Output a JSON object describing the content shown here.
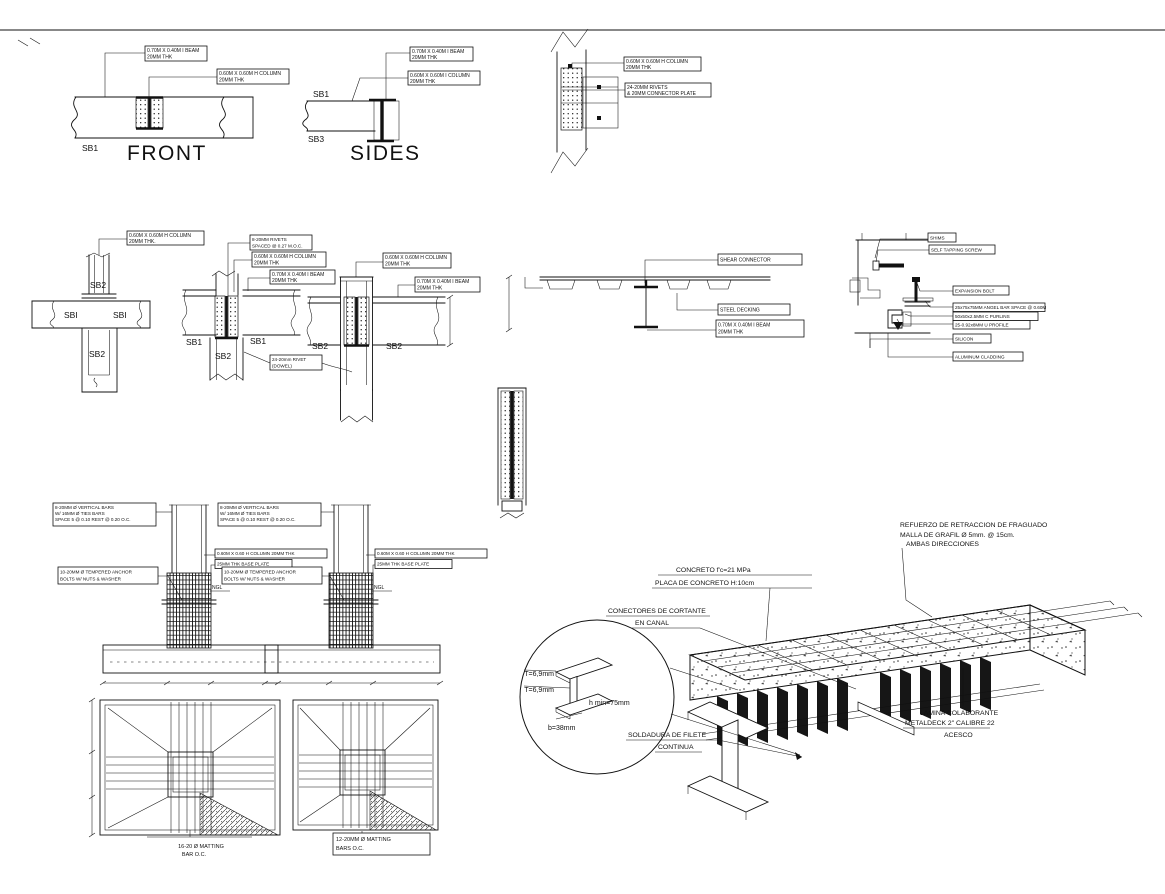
{
  "drawing": {
    "front_view": {
      "title": "FRONT",
      "member": "SB1",
      "beam_callout": [
        "0.70M X 0.40M I BEAM",
        "20MM THK"
      ],
      "column_callout": [
        "0.60M X 0.60M H COLUMN",
        "20MM THK"
      ]
    },
    "sides_view": {
      "title": "SIDES",
      "member_top": "SB1",
      "member_bottom": "SB3",
      "beam_callout": [
        "0.70M X 0.40M I BEAM",
        "20MM THK"
      ],
      "column_callout": [
        "0.60M X 0.60M I COLUMN",
        "20MM THK"
      ]
    },
    "splice_detail": {
      "column_callout": [
        "0.60M X 0.60M H COLUMN",
        "20MM THK"
      ],
      "rivets_callout": [
        "24-20MM RIVETS",
        "& 20MM CONNECTOR PLATE"
      ]
    },
    "plan_detail": {
      "column_callout": [
        "0.60M X 0.60M H COLUMN",
        "20MM THK."
      ],
      "member_top": "SB2",
      "member_left": "SBI",
      "member_right": "SBI",
      "member_bottom": "SB2"
    },
    "beam_column_detail_1": {
      "rivets_callout": [
        "8-20MM RIVETS",
        "SPACED @ 0.27 M.O.C."
      ],
      "column_callout": [
        "0.60M X 0.60M H COLUMN",
        "20MM THK"
      ],
      "beam_callout": [
        "0.70M X 0.40M I BEAM",
        "20MM THK"
      ],
      "member_left": "SB1",
      "member_right": "SB1",
      "member_bottom": "SB2",
      "rivet_note": [
        "24-20mm RIVET",
        "(DOWEL)"
      ]
    },
    "beam_column_detail_2": {
      "column_callout": [
        "0.60M X 0.60M H COLUMN",
        "20MM THK"
      ],
      "beam_callout": [
        "0.70M X 0.40M I BEAM",
        "20MM THK"
      ],
      "member_left": "SB2",
      "member_right": "SB2"
    },
    "deck_section": {
      "shear_connector": "SHEAR CONNECTOR",
      "steel_decking": "STEEL DECKING",
      "beam_callout": [
        "0.70M X 0.40M I BEAM",
        "20MM THK"
      ]
    },
    "cladding_detail": {
      "labels": [
        "SHIMS",
        "SELF TAPPING SCREW",
        "EXPANSION BOLT",
        "25x75x75MM ANGEL BAR SPACE @ 0.60M",
        "50x50x2.5MM C PURLINS",
        "25-0.92x8MM U PROFILE",
        "SILICON",
        "ALUMINUM CLADDING"
      ]
    },
    "pedestal_detail_left": {
      "vertical_bars_callout": [
        "8-20MM Ø VERTICAL BARS",
        "W/ 16MM Ø TIES BARS",
        "SPACE 5 @ 0.10 REST @ 0.20 O.C."
      ],
      "column_callout": "0.60M X 0.60 H COLUMN 20MM THK",
      "base_plate_callout": "25MM THK BASE PLATE",
      "anchor_callout": [
        "10-20MM Ø TEMPERED ANCHOR",
        "BOLTS W/ NUTS & WASHER"
      ],
      "ground_label": "NGL",
      "matting_label": [
        "16-20 Ø MATTING",
        "BAR O.C."
      ]
    },
    "pedestal_detail_right": {
      "vertical_bars_callout": [
        "8-20MM Ø VERTICAL BARS",
        "W/ 16MM Ø TIES BARS",
        "SPACE 5 @ 0.10 REST @ 0.20 O.C."
      ],
      "column_callout": "0.60M X 0.60 H COLUMN 20MM THK",
      "base_plate_callout": "25MM THK BASE PLATE",
      "anchor_callout": [
        "10-20MM Ø TEMPERED ANCHOR",
        "BOLTS W/ NUTS & WASHER"
      ],
      "ground_label": "NGL",
      "matting_label": [
        "12-20MM Ø MATTING",
        "BARS O.C."
      ]
    },
    "isometric_detail": {
      "shrinkage_callout": [
        "REFUERZO DE RETRACCION DE FRAGUADO",
        "MALLA DE GRAFIL Ø 5mm. @ 15cm.",
        "AMBAS DIRECCIONES"
      ],
      "concrete_callout": [
        "CONCRETO f'c=21 MPa",
        "PLACA DE CONCRETO H:10cm"
      ],
      "connectors_callout": [
        "CONECTORES DE CORTANTE",
        "EN CANAL"
      ],
      "deck_callout": [
        "LAMINA COLABORANTE",
        "METALDECK 2\" CALIBRE 22",
        "ACESCO"
      ],
      "weld_callout": [
        "SOLDADURA DE FILETE",
        "CONTINUA"
      ],
      "channel_detail": {
        "t_top": "T=6,9mm",
        "t_bottom": "T=6,9mm",
        "h_min": "h  min=75mm",
        "b": "b=38mm"
      }
    }
  }
}
